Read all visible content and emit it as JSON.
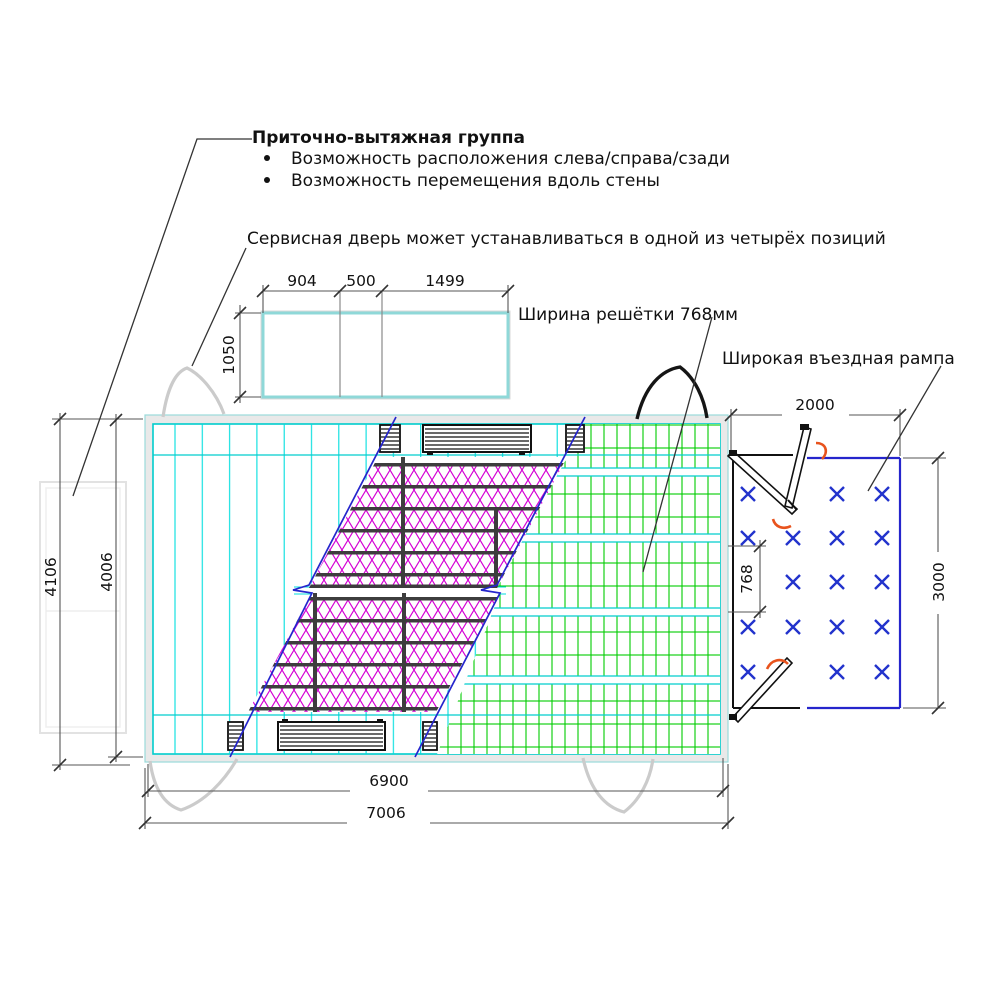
{
  "drawing": {
    "title": "Приточно-вытяжная группа",
    "bullet_1": "Возможность расположения слева/справа/сзади",
    "bullet_2": "Возможность перемещения вдоль стены",
    "service_door_note": "Сервисная дверь может устанавливаться в одной из четырёх позиций",
    "grille_width_note": "Ширина решётки 768мм",
    "ramp_note": "Широкая въездная рампа",
    "dims": {
      "d904": "904",
      "d500": "500",
      "d1499": "1499",
      "d1050": "1050",
      "d4106": "4106",
      "d4006": "4006",
      "d2000": "2000",
      "d3000": "3000",
      "d768": "768",
      "d6900": "6900",
      "d7006": "7006"
    },
    "colors": {
      "cyan": "#00cdcd",
      "magenta": "#d400d4",
      "green": "#00cc00",
      "blue": "#2525cc",
      "orange": "#e8531d",
      "gray_arc": "#cbcbcb"
    }
  }
}
